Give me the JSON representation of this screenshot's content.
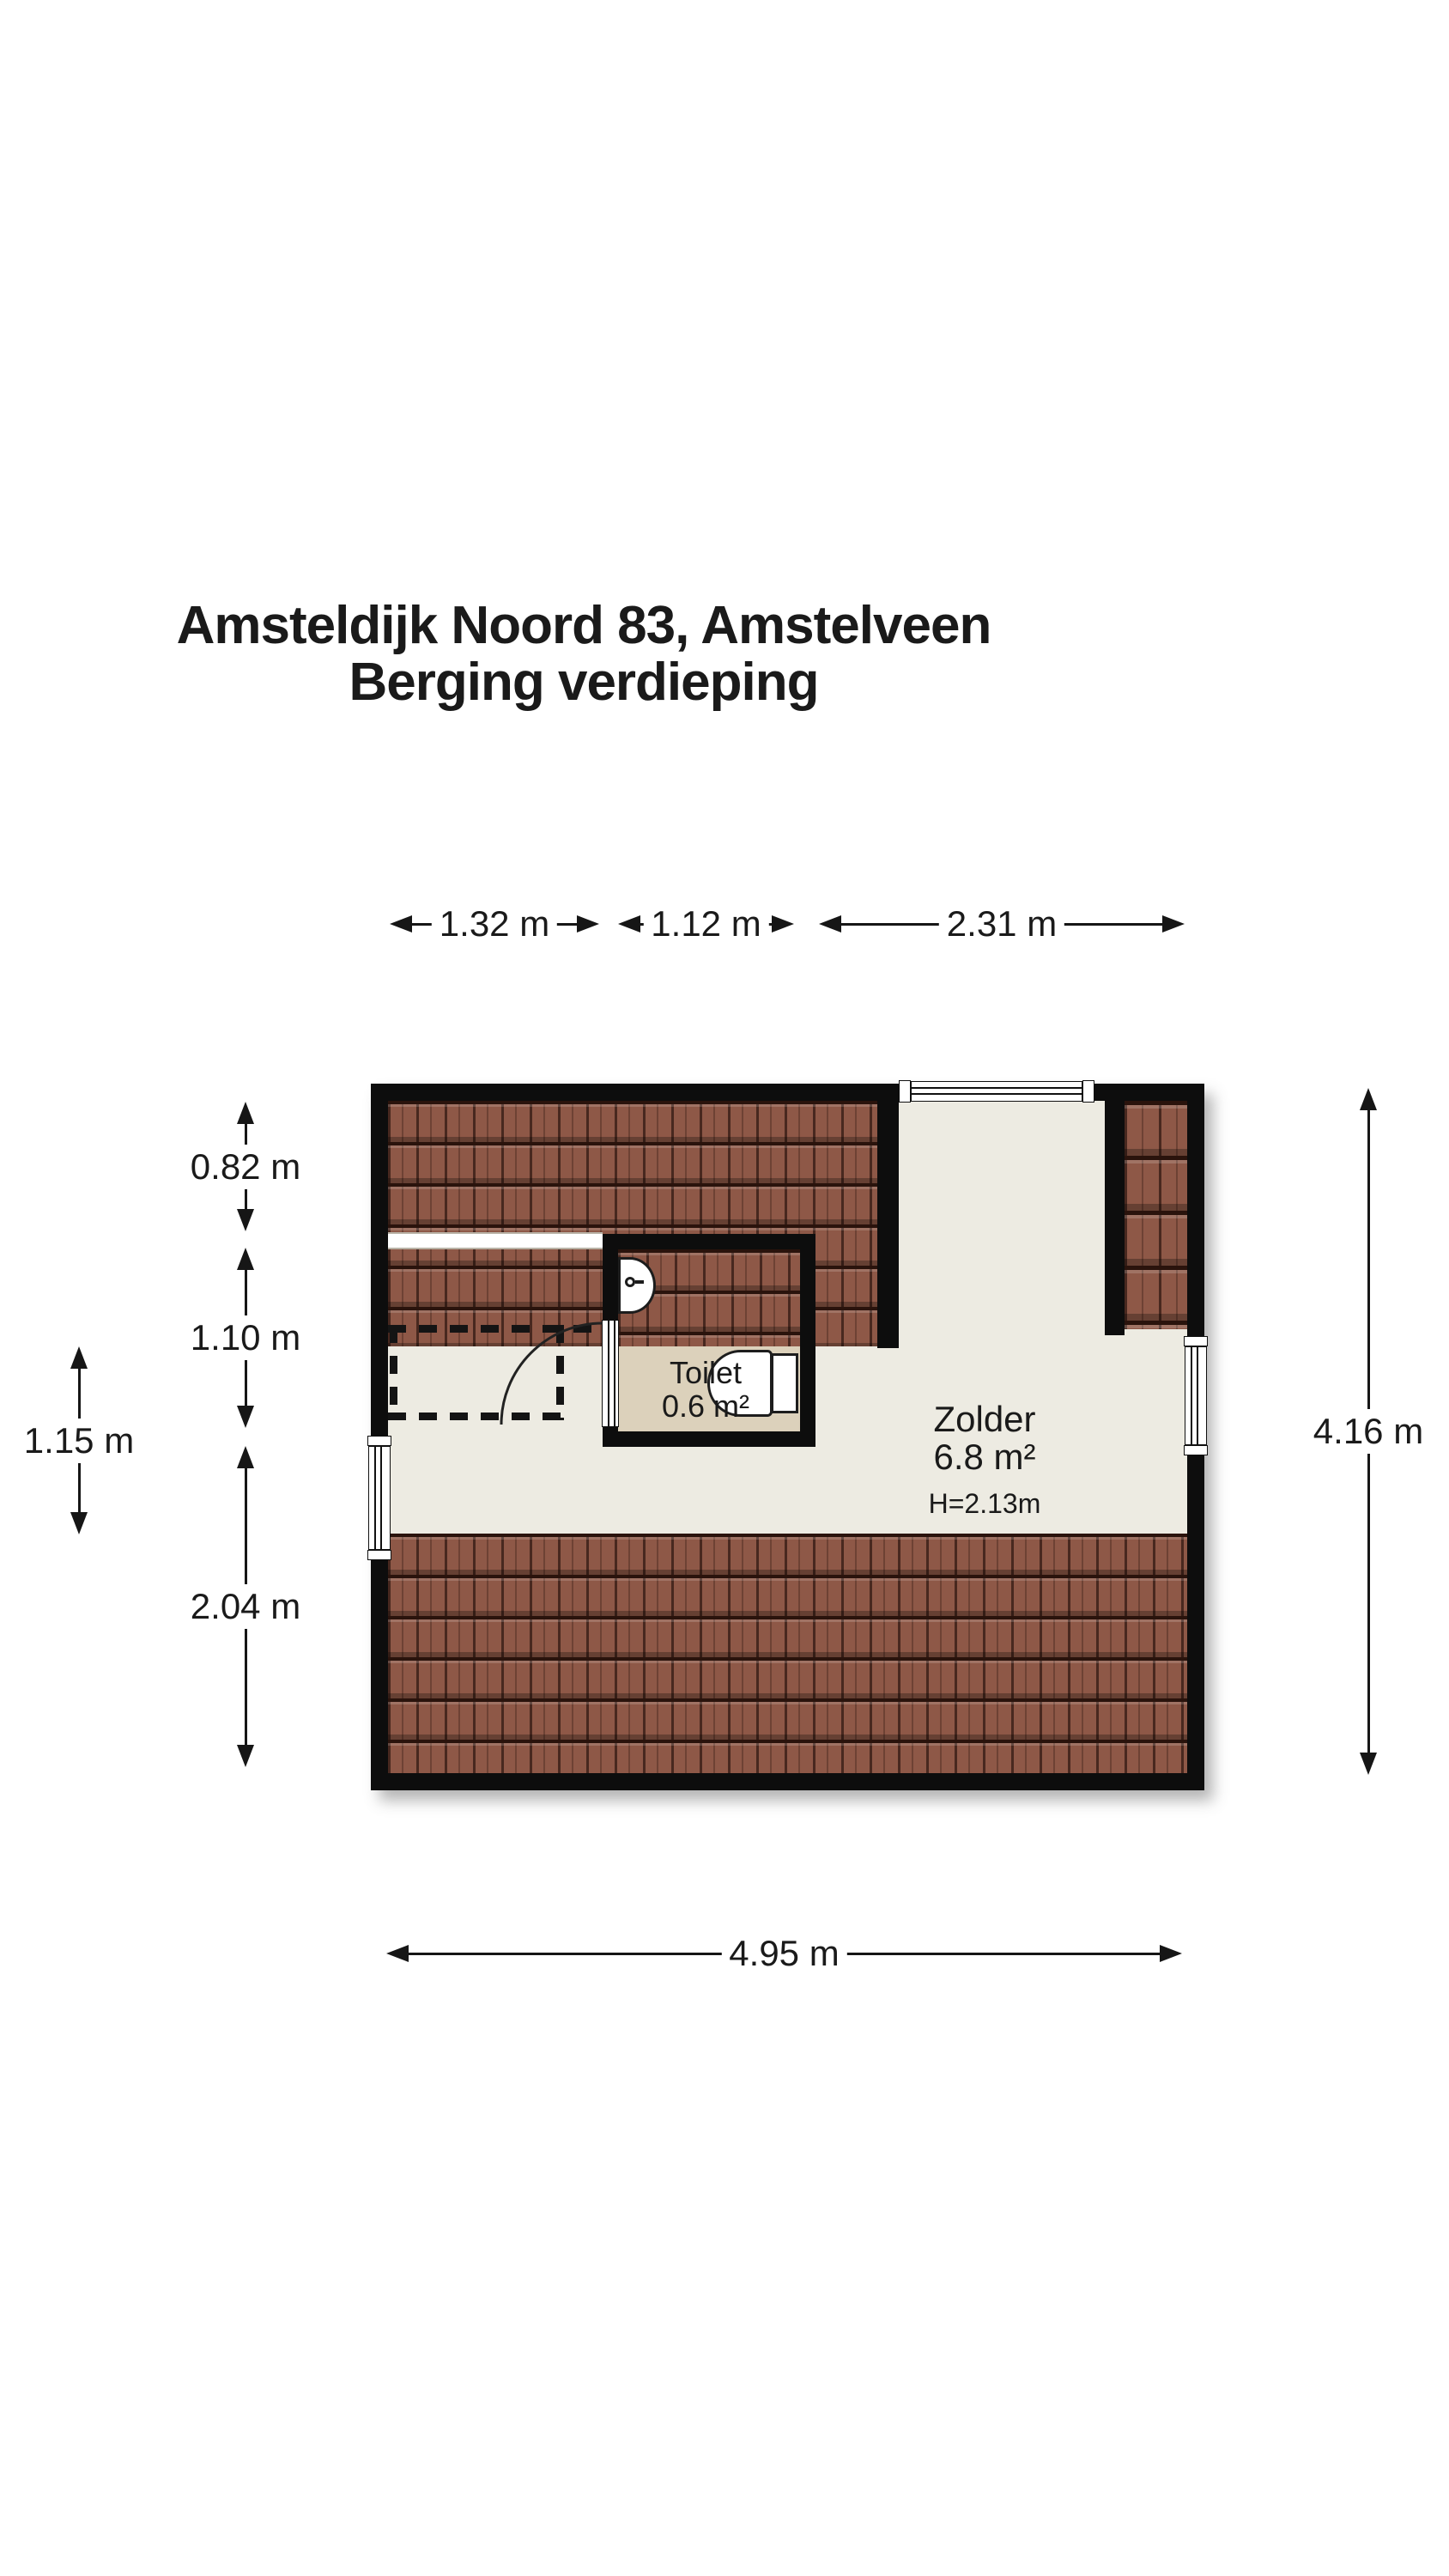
{
  "title": {
    "line1": "Amsteldijk Noord 83, Amstelveen",
    "line2": "Berging verdieping"
  },
  "dimensions": {
    "top": [
      "1.32 m",
      "1.12 m",
      "2.31 m"
    ],
    "left": [
      "0.82 m",
      "1.10 m",
      "2.04 m"
    ],
    "far_left": "1.15 m",
    "right": "4.16 m",
    "bottom": "4.95 m"
  },
  "rooms": {
    "toilet": {
      "name": "Toilet",
      "area": "0.6 m²"
    },
    "zolder": {
      "name": "Zolder",
      "area": "6.8 m²",
      "ceiling_height": "H=2.13m"
    }
  },
  "features": {
    "windows": [
      "top-wall-window",
      "left-wall-window",
      "right-wall-window"
    ],
    "fixtures": [
      "toilet-bowl",
      "toilet-tank",
      "sink"
    ],
    "roof_sections": [
      "top-left-roof",
      "right-roof-strip",
      "bottom-roof"
    ],
    "skylight": "roof-light-band",
    "door": "toilet-door-with-swing-arc"
  },
  "colors": {
    "wall": "#0d0d0d",
    "roof_tile": "#8e5847",
    "floor": "#edebe2",
    "toilet_floor": "#dcd1bb",
    "text": "#1a1a1a"
  }
}
